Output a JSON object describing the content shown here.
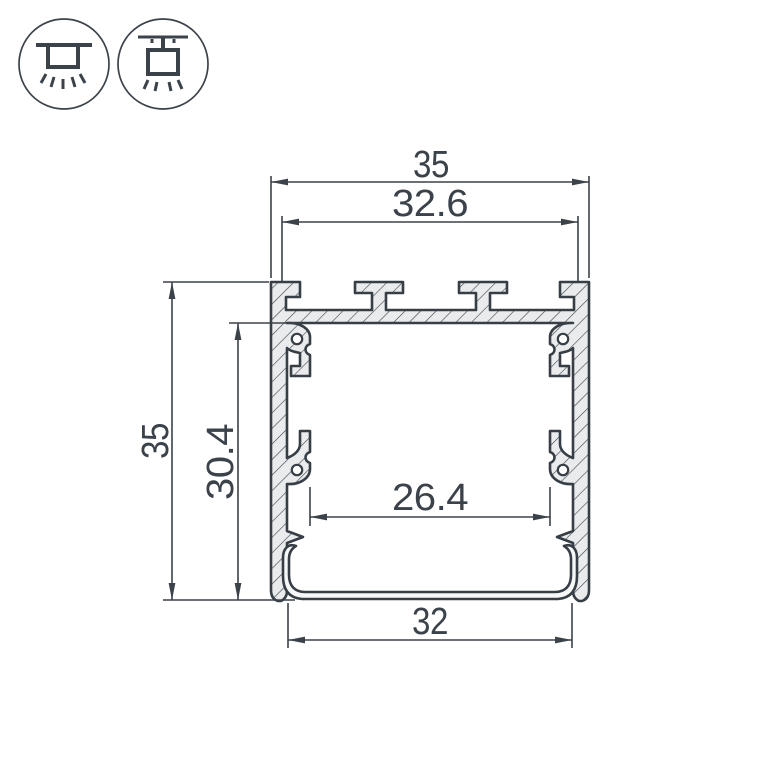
{
  "drawing": {
    "title": "led-profile-cross-section",
    "dimensions": {
      "top_width": "35",
      "top_inner_width": "32.6",
      "overall_height": "35",
      "inner_height": "30.4",
      "inner_width": "26.4",
      "bottom_width": "32"
    },
    "icons": [
      {
        "name": "surface-mount-icon",
        "meaning": "surface mounted luminaire"
      },
      {
        "name": "pendant-mount-icon",
        "meaning": "suspended luminaire"
      }
    ],
    "colors": {
      "line": "#3b424a",
      "hatch_fill": "#e9ebec",
      "lens_fill": "#f6f7f7",
      "background": "#ffffff"
    }
  }
}
